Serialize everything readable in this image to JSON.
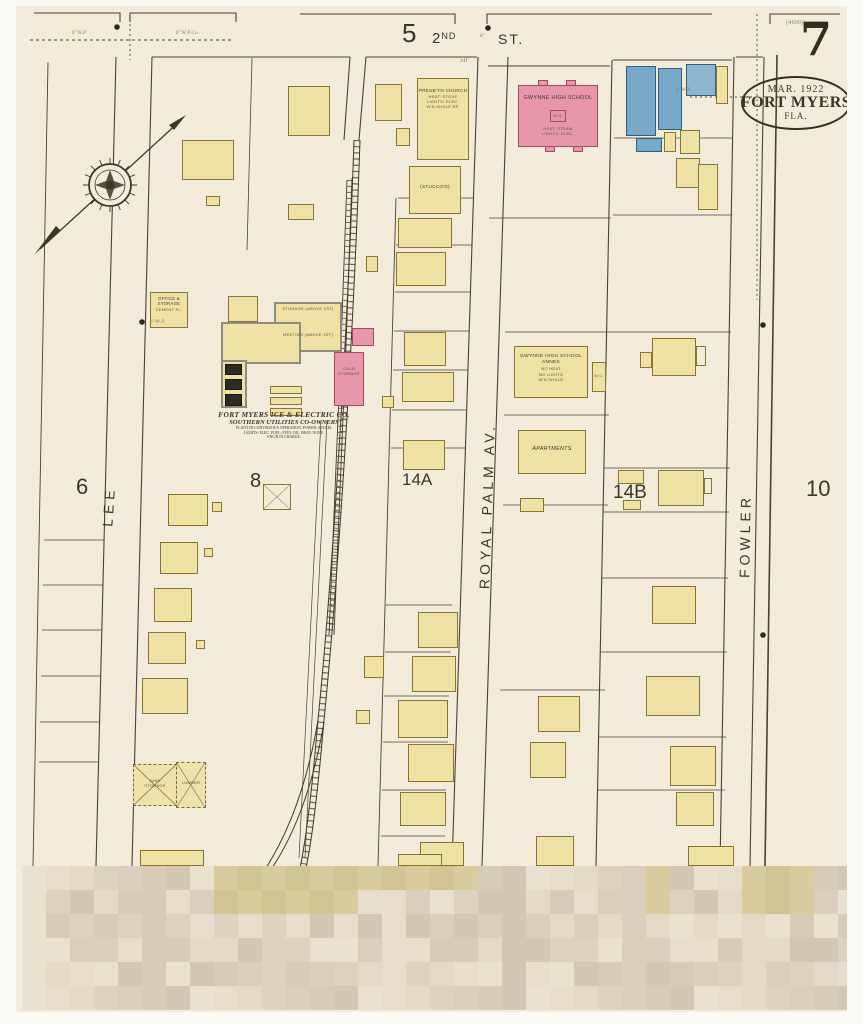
{
  "sheet": {
    "number": "7",
    "stamp_date": "Mar. 1922",
    "stamp_city": "Fort Myers",
    "stamp_state": "Fla.",
    "corner_ref": "(4600)"
  },
  "streets": {
    "second_num": "5",
    "second_name": "2",
    "second_ord": "ND",
    "second_suffix": "ST.",
    "lee": "LEE",
    "royal_palm": "ROYAL PALM AV.",
    "fowler": "FOWLER",
    "dim50": "50'"
  },
  "blocks": {
    "b6": "6",
    "b8": "8",
    "b14a": "14A",
    "b14b": "14B",
    "b10": "10"
  },
  "utilities": {
    "wp": "6''W.P.",
    "wpco": "6''W.P.Co.",
    "m8": "8''"
  },
  "buildings": {
    "church_name": "PRESB'YN CHURCH",
    "church_n1": "HEAT: STOVE",
    "church_n2": "LIGHTS: ELEC.",
    "church_n3": "W'N SHGLE RF.",
    "stuccod": "(STUCCO'D)",
    "school_name": "GWYNNE HIGH SCHOOL",
    "school_wg": "W.G.",
    "school_n1": "HEAT: STEAM",
    "school_n2": "LIGHTS: ELEC.",
    "annex_l1": "GWYNNE HIGH SCHOOL",
    "annex_l2": "ANNEX",
    "annex_n1": "NO HEAT",
    "annex_n2": "NO LIGHTS",
    "annex_n3": "W'N SHGLE",
    "wc": "W.C.",
    "apartments": "APARTMENTS",
    "office_l1": "OFFICE &",
    "office_l2": "STORAGE",
    "office_l3": "CEMENT FL.",
    "storage_above": "STORAGE (ABOVE 1ST)",
    "meeting_above": "MEETING (ABOVE 1ST)",
    "cold_l1": "COLD",
    "cold_l2": "STORAGE",
    "junk_l1": "JUNK",
    "junk_l2": "STORAGE",
    "lumber": "LUMBER"
  },
  "caption": {
    "c1": "Fort Myers Ice & Electric Co.",
    "c2": "Southern Utilities Co-Owners",
    "c3": "PLANT IN CONTINUOUS OPERATION. POWER: STEAM.",
    "c4": "LIGHTS: ELEC. FUEL: FUEL OIL. HEAT: NONE.",
    "c5": "ENG'R IN CHARGE."
  },
  "colors": {
    "paper": "#f3ecda",
    "frame_yellow": "#f0e2a4",
    "brick_pink": "#e897aa",
    "concrete_blue": "#79a9c8",
    "ink": "#3b352a"
  },
  "mosaic": {
    "palette": [
      "#eae2d1",
      "#e3dac8",
      "#dad0bd",
      "#d2c8b4",
      "#e7decd",
      "#ddd3c0",
      "#d6ccb8"
    ],
    "accents": [
      "#d9cd9f",
      "#d2c594"
    ]
  }
}
